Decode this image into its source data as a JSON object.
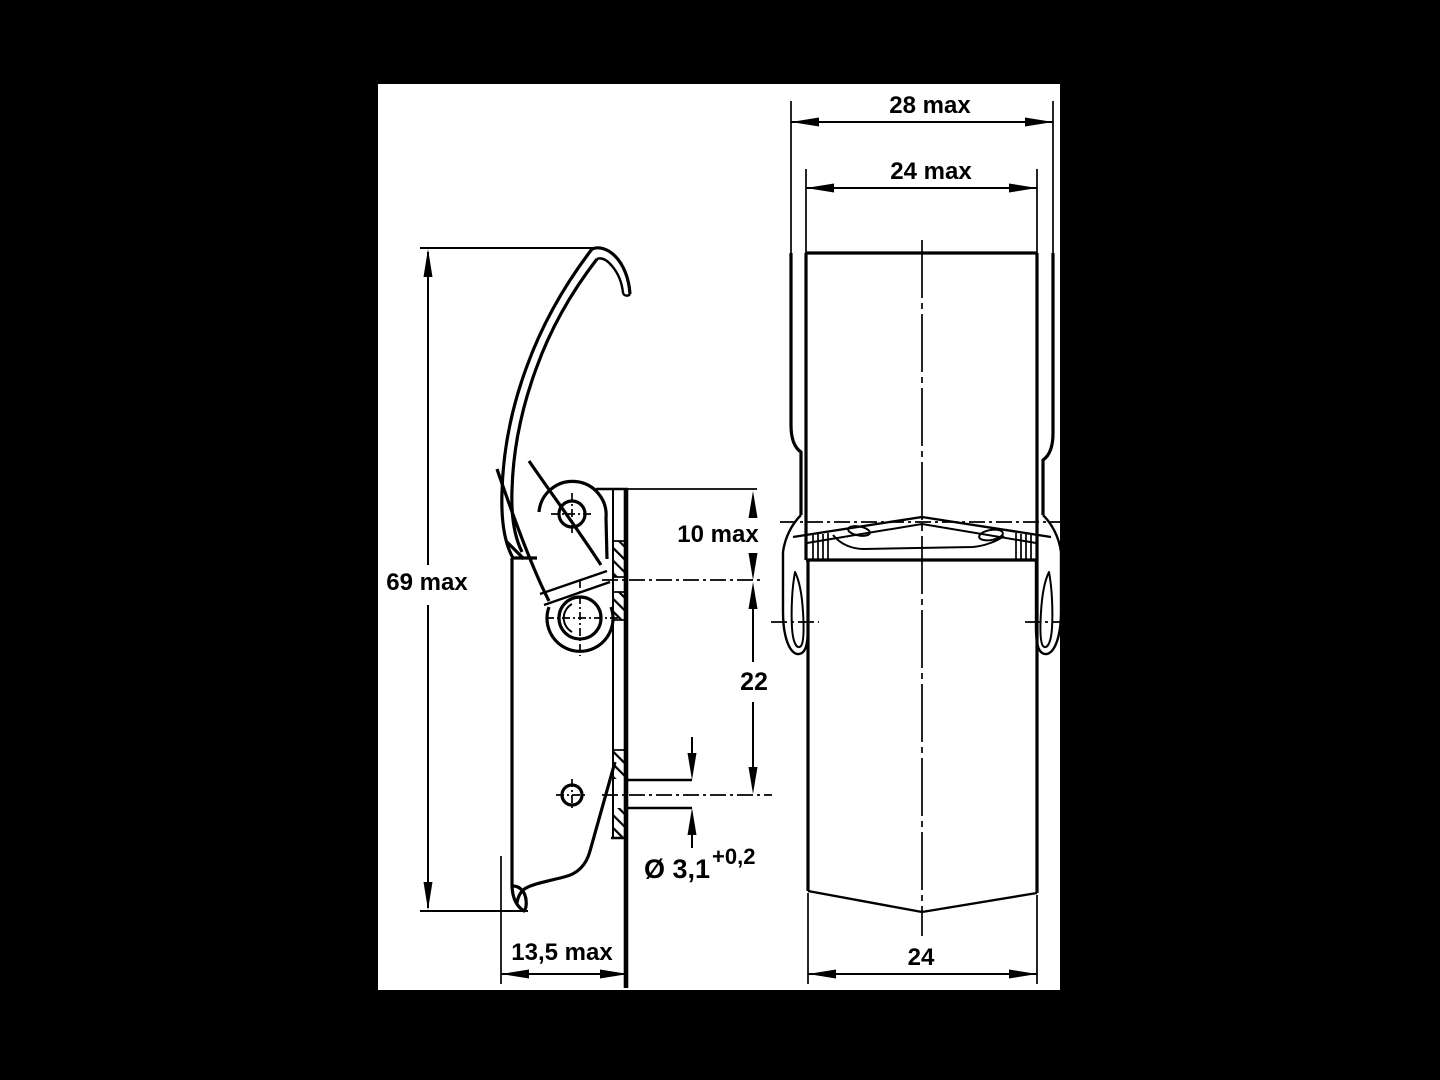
{
  "page": {
    "background": "#000000",
    "paper": "#ffffff",
    "ink": "#000000"
  },
  "dimensions": {
    "front_width_outer": "28 max",
    "front_width_inner": "24 max",
    "side_height": "69 max",
    "plate_top_to_upper_slot": "10 max",
    "slot_center_distance": "22",
    "hole_diameter": "Ø 3,1",
    "hole_diameter_tolerance": "+0,2",
    "side_depth": "13,5 max",
    "front_width_base": "24"
  }
}
